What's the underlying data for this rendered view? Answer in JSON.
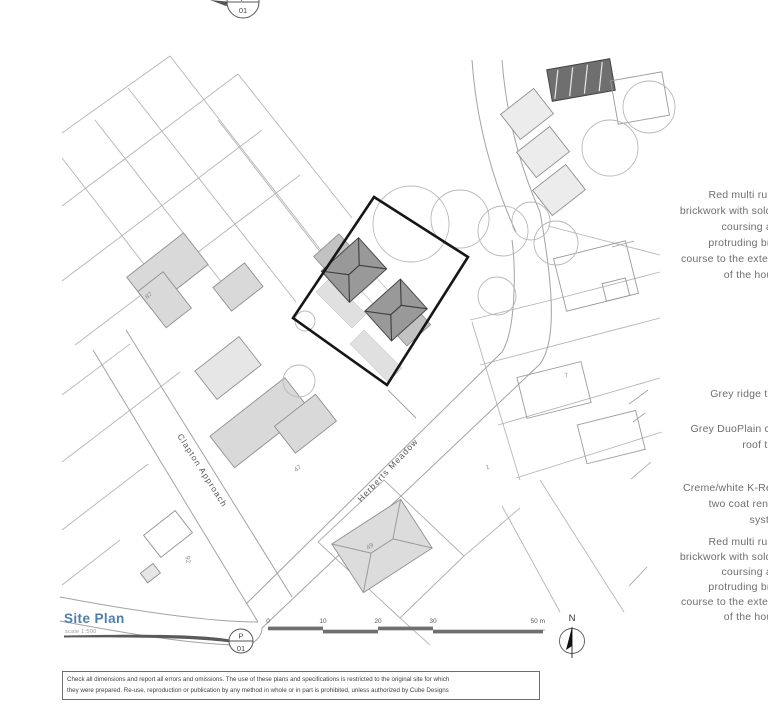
{
  "plan": {
    "title": "Site Plan",
    "scale_note": "scale 1:500",
    "bubble": {
      "top": "P",
      "bottom": "01"
    },
    "north": "N",
    "scalebar": {
      "t0": "0",
      "t10": "10",
      "t20": "20",
      "t30": "30",
      "t50": "50 m"
    },
    "roads": {
      "clapton": "Clapton Approach",
      "herberts": "Herberts Meadow"
    },
    "numbers": {
      "n87": "87",
      "n47": "47",
      "n92": "92",
      "n49": "49",
      "n1": "1",
      "n7": "7"
    },
    "annotations": {
      "brick": [
        "Red multi rustic",
        "brickwork with soldier",
        "coursing and",
        "protruding brick",
        "course to the exterior",
        "of the house"
      ],
      "ridge": [
        "Grey ridge tiles"
      ],
      "duoplain": [
        "Grey DuoPlain clay",
        "roof tiles"
      ],
      "render": [
        "Creme/white  K-Rend",
        "two coat render",
        "system"
      ]
    },
    "disclaimer": {
      "line1": "Check all dimensions and report all errors and omissions. The use of these plans and specifications is restricted to the original site for which",
      "line2": "they were prepared. Re-use, reproduction or publication by any method in whole or in part is prohibited, unless authorized by Cube Designs"
    },
    "colors": {
      "title_blue": "#4e7fa8",
      "boundary_black": "#161616",
      "roof_grey": "#999999",
      "building_grey": "#d9d9d9",
      "line_grey": "#b5b5b5",
      "annotation_grey": "#6e6e6e"
    }
  }
}
